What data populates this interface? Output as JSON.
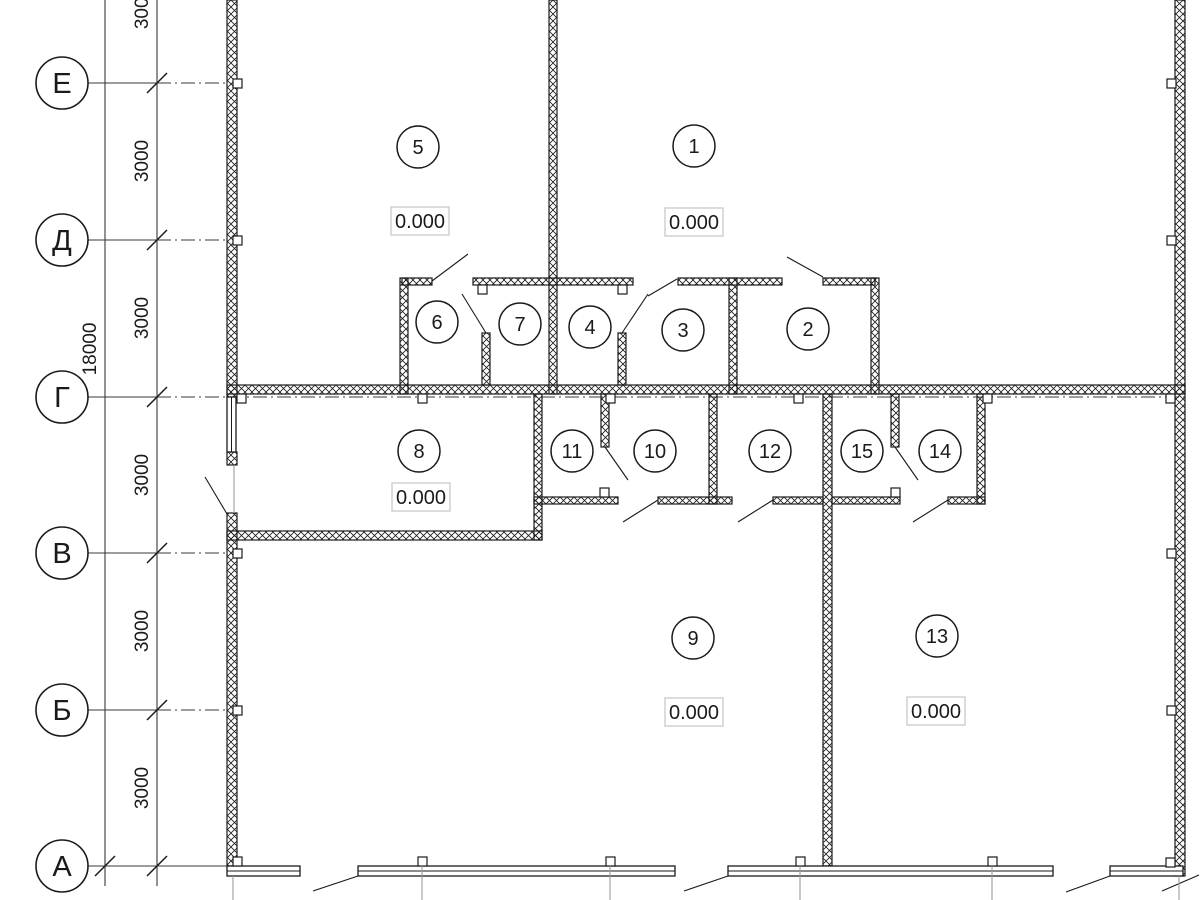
{
  "title": "Architectural floor plan (CAD drawing)",
  "grid": {
    "rows": [
      {
        "label": "Е"
      },
      {
        "label": "Д"
      },
      {
        "label": "Г"
      },
      {
        "label": "В"
      },
      {
        "label": "Б"
      },
      {
        "label": "А"
      }
    ]
  },
  "dimensions": {
    "bay_labels": [
      "3000",
      "3000",
      "3000",
      "3000",
      "3000",
      "3000"
    ],
    "total": "18000"
  },
  "rooms": [
    {
      "number": "5",
      "elevation": "0.000"
    },
    {
      "number": "1",
      "elevation": "0.000"
    },
    {
      "number": "6"
    },
    {
      "number": "7"
    },
    {
      "number": "4"
    },
    {
      "number": "3"
    },
    {
      "number": "2"
    },
    {
      "number": "8",
      "elevation": "0.000"
    },
    {
      "number": "11"
    },
    {
      "number": "10"
    },
    {
      "number": "12"
    },
    {
      "number": "15"
    },
    {
      "number": "14"
    },
    {
      "number": "9",
      "elevation": "0.000"
    },
    {
      "number": "13",
      "elevation": "0.000"
    }
  ],
  "colors": {
    "line": "#1a1a1a",
    "extension_line": "#9a9a9a",
    "elevation_box_border": "#c4c4c4",
    "background": "#ffffff"
  }
}
